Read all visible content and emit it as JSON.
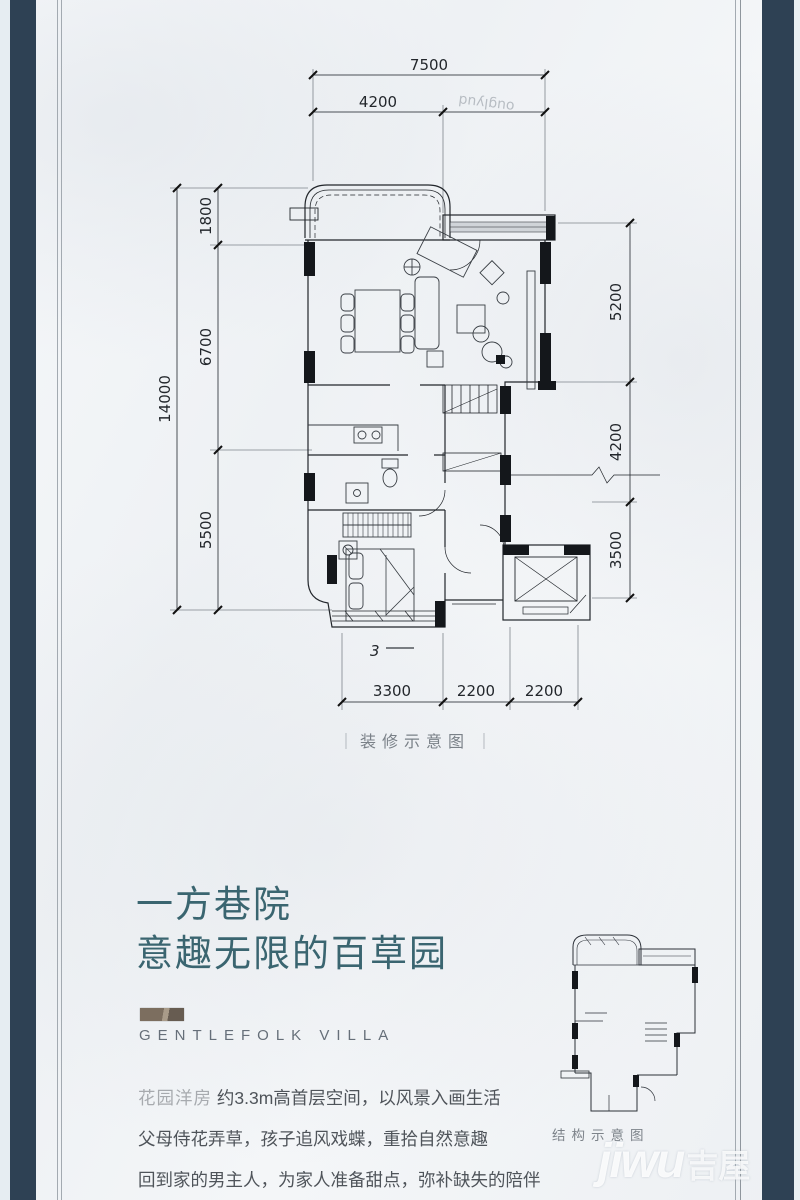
{
  "colors": {
    "navy": "#2e4154",
    "teal": "#3a6570"
  },
  "floorplan": {
    "caption": "装修示意图",
    "caption_bar": "｜",
    "note": "3",
    "dims": {
      "top_total": "7500",
      "top_left": "4200",
      "left_total": "14000",
      "left_segments": [
        "1800",
        "6700",
        "5500"
      ],
      "right_segments": [
        "5200",
        "4200",
        "3500"
      ],
      "bottom_segments": [
        "3300",
        "2200",
        "2200"
      ]
    }
  },
  "structure": {
    "caption": "结构示意图"
  },
  "headline": {
    "line1": "一方巷院",
    "line2": "意趣无限的百草园"
  },
  "brand": {
    "name": "GENTLEFOLK VILLA"
  },
  "body_text": {
    "line1_prefix": "花园洋房",
    "line1": "约3.3m高首层空间，以风景入画生活",
    "line2": "父母侍花弄草，孩子追风戏蝶，重拾自然意趣",
    "line3": "回到家的男主人，为家人准备甜点，弥补缺失的陪伴"
  },
  "watermark": {
    "logo": "jiwu",
    "suffix": "吉屋",
    "artifact": "ouglyud"
  }
}
